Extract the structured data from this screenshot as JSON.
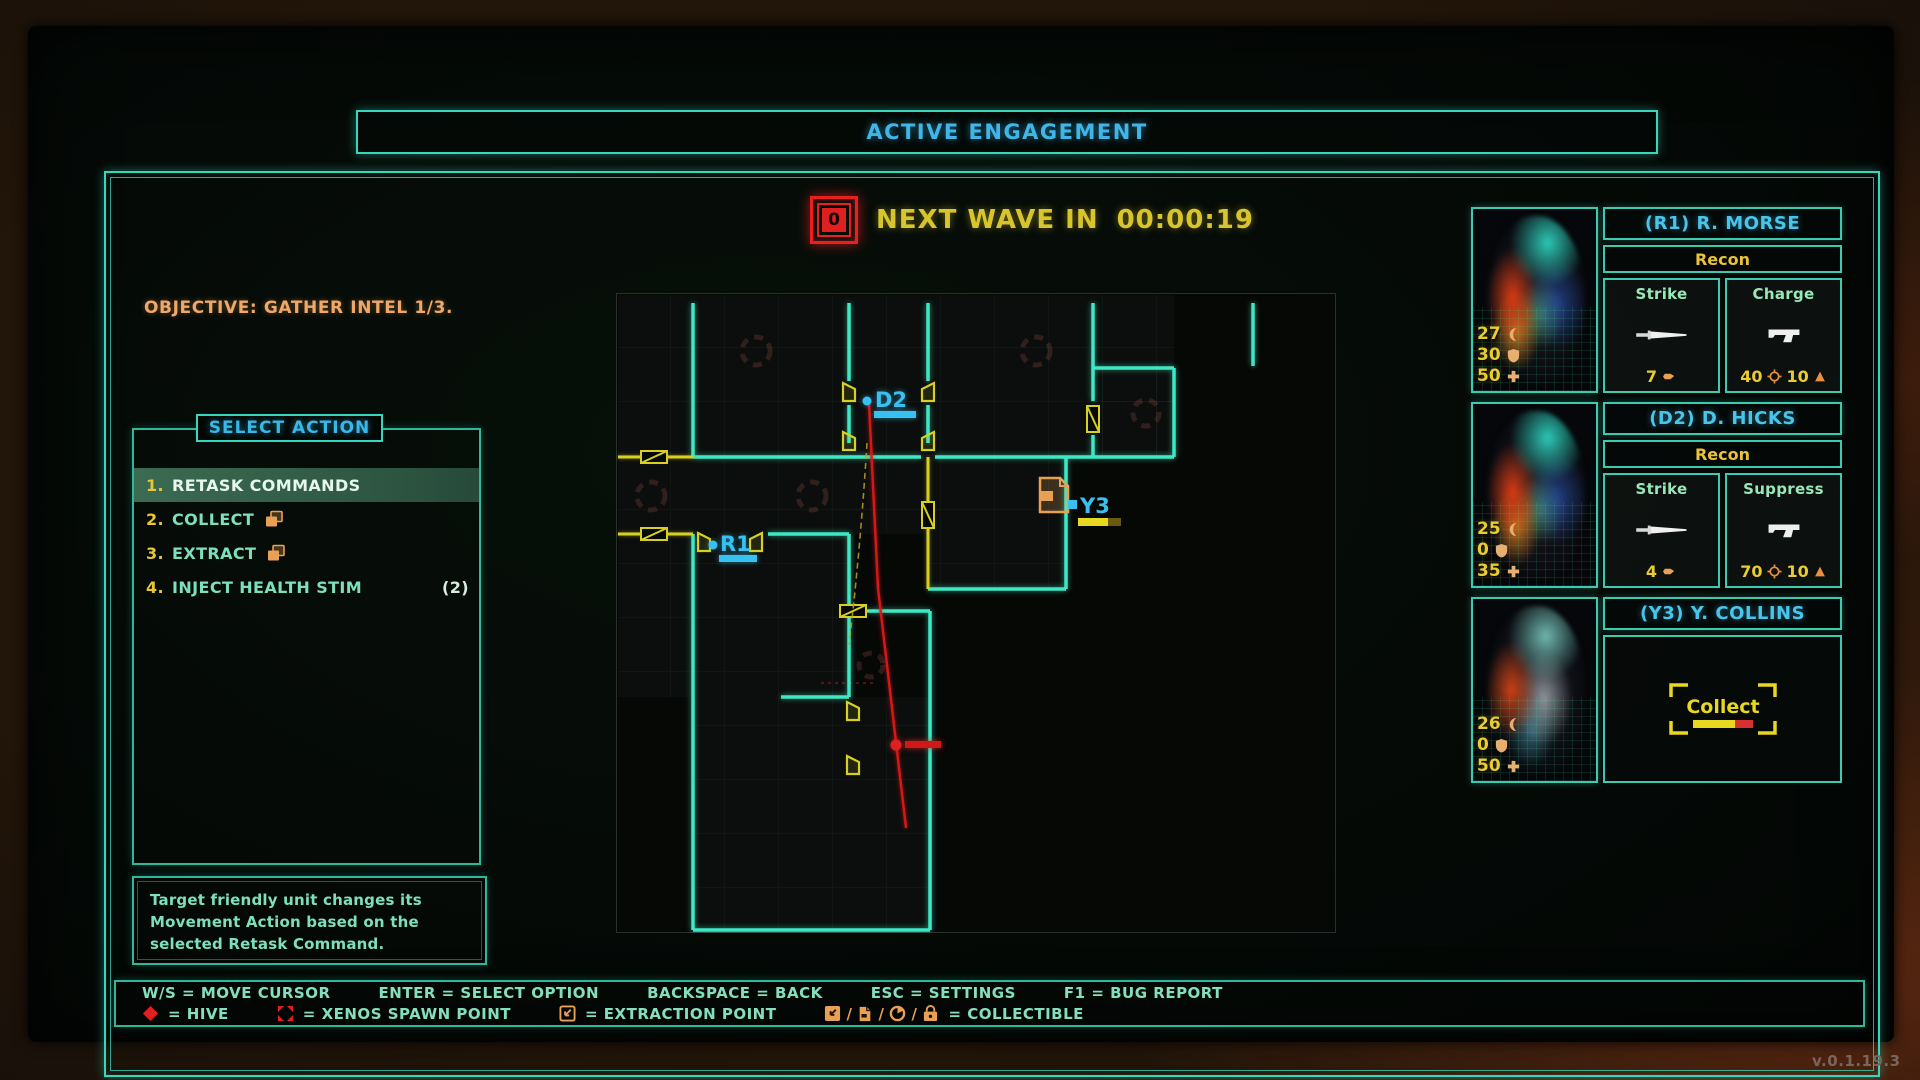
{
  "header": {
    "title": "ACTIVE ENGAGEMENT"
  },
  "wave": {
    "icon": "wave-alert-icon",
    "icon_label": "0",
    "label": "NEXT WAVE IN",
    "timer": "00:00:19"
  },
  "objective": "OBJECTIVE: GATHER INTEL 1/3.",
  "menu": {
    "title": "SELECT ACTION",
    "items": [
      {
        "num": "1.",
        "label": "RETASK COMMANDS",
        "selected": true
      },
      {
        "num": "2.",
        "label": "COLLECT",
        "icon": "documents-icon"
      },
      {
        "num": "3.",
        "label": "EXTRACT",
        "icon": "documents-icon"
      },
      {
        "num": "4.",
        "label": "INJECT HEALTH STIM",
        "count": "(2)"
      }
    ],
    "description": "Target friendly unit changes its Movement Action based on the selected Retask Command."
  },
  "map": {
    "units": [
      {
        "id": "D2"
      },
      {
        "id": "R1"
      },
      {
        "id": "Y3"
      }
    ],
    "markers": {
      "enemy": "enemy-dot",
      "collectible": "document-collectible-icon"
    }
  },
  "squad": [
    {
      "name": "(R1) R. MORSE",
      "cls": "Recon",
      "stats": {
        "speed": "27",
        "armor": "30",
        "health": "50"
      },
      "abilities": [
        {
          "name": "Strike",
          "icon": "knife-icon",
          "cost": "7"
        },
        {
          "name": "Charge",
          "icon": "pistol-icon",
          "acc": "40",
          "ammo": "10"
        }
      ]
    },
    {
      "name": "(D2) D. HICKS",
      "cls": "Recon",
      "stats": {
        "speed": "25",
        "armor": "0",
        "health": "35"
      },
      "abilities": [
        {
          "name": "Strike",
          "icon": "knife-icon",
          "cost": "4"
        },
        {
          "name": "Suppress",
          "icon": "pistol-icon",
          "acc": "70",
          "ammo": "10"
        }
      ]
    },
    {
      "name": "(Y3) Y. COLLINS",
      "stats": {
        "speed": "26",
        "armor": "0",
        "health": "50"
      },
      "action": {
        "label": "Collect",
        "progress_pct": 70
      }
    }
  ],
  "help": {
    "keys": [
      "W/S = MOVE CURSOR",
      "ENTER = SELECT OPTION",
      "BACKSPACE = BACK",
      "ESC = SETTINGS",
      "F1 = BUG REPORT"
    ],
    "legend": [
      {
        "icon": "hive-icon",
        "label": "= HIVE"
      },
      {
        "icon": "xenos-spawn-icon",
        "label": "= XENOS SPAWN POINT"
      },
      {
        "icon": "extraction-icon",
        "label": "= EXTRACTION POINT"
      },
      {
        "icons": [
          "arrow-square-icon",
          "document-icon",
          "disc-icon",
          "lock-icon"
        ],
        "separator": "/",
        "label": "= COLLECTIBLE"
      }
    ]
  },
  "version": "v.0.1.19.3",
  "colors": {
    "accent_cyan": "#35d8bc",
    "accent_blue": "#3fb6e8",
    "accent_yellow": "#e8c832",
    "accent_orange": "#e8a055",
    "accent_red": "#e02020",
    "map_wall": "#3ee8c4",
    "map_door": "#d8d020"
  }
}
